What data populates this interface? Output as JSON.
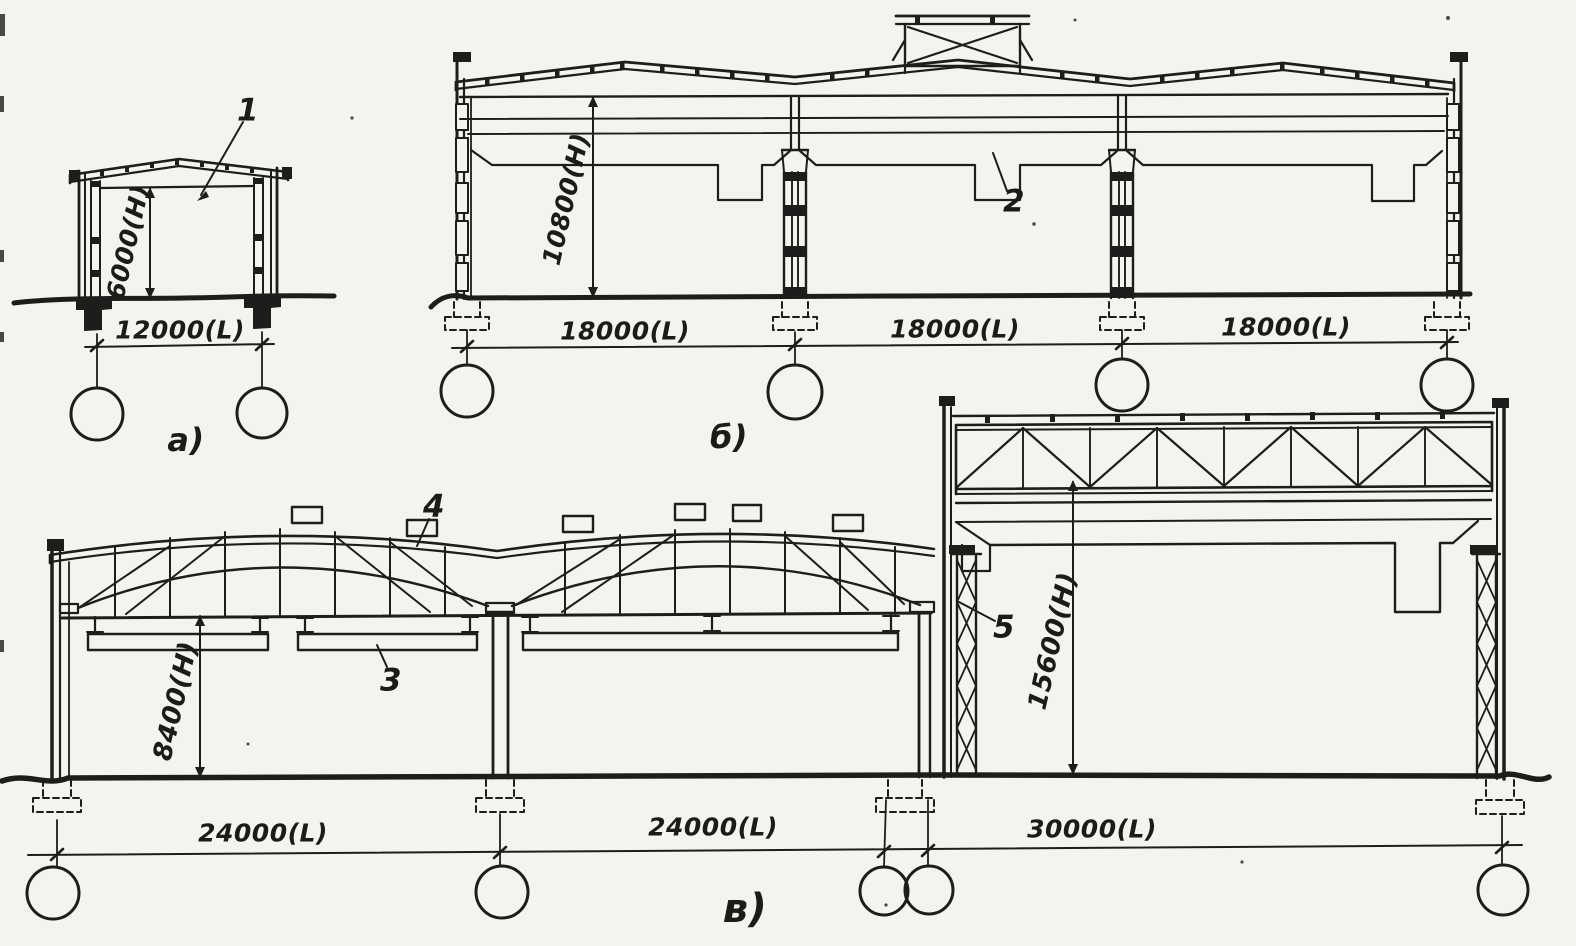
{
  "palette": {
    "paper": "#f4f3ef",
    "ink": "#1d1d1b"
  },
  "sections": {
    "a": {
      "label": "а)",
      "callout_1": "1",
      "height_dim": "6000(H)",
      "span_dim": "12000(L)"
    },
    "b": {
      "label": "б)",
      "callout_2": "2",
      "height_dim": "10800(H)",
      "span_dim_1": "18000(L)",
      "span_dim_2": "18000(L)",
      "span_dim_3": "18000(L)"
    },
    "v": {
      "label": "в)",
      "callout_3": "3",
      "callout_4": "4",
      "callout_5": "5",
      "height_dim_left": "8400(H)",
      "height_dim_right": "15600(H)",
      "span_dim_1": "24000(L)",
      "span_dim_2": "24000(L)",
      "span_dim_3": "30000(L)"
    }
  }
}
